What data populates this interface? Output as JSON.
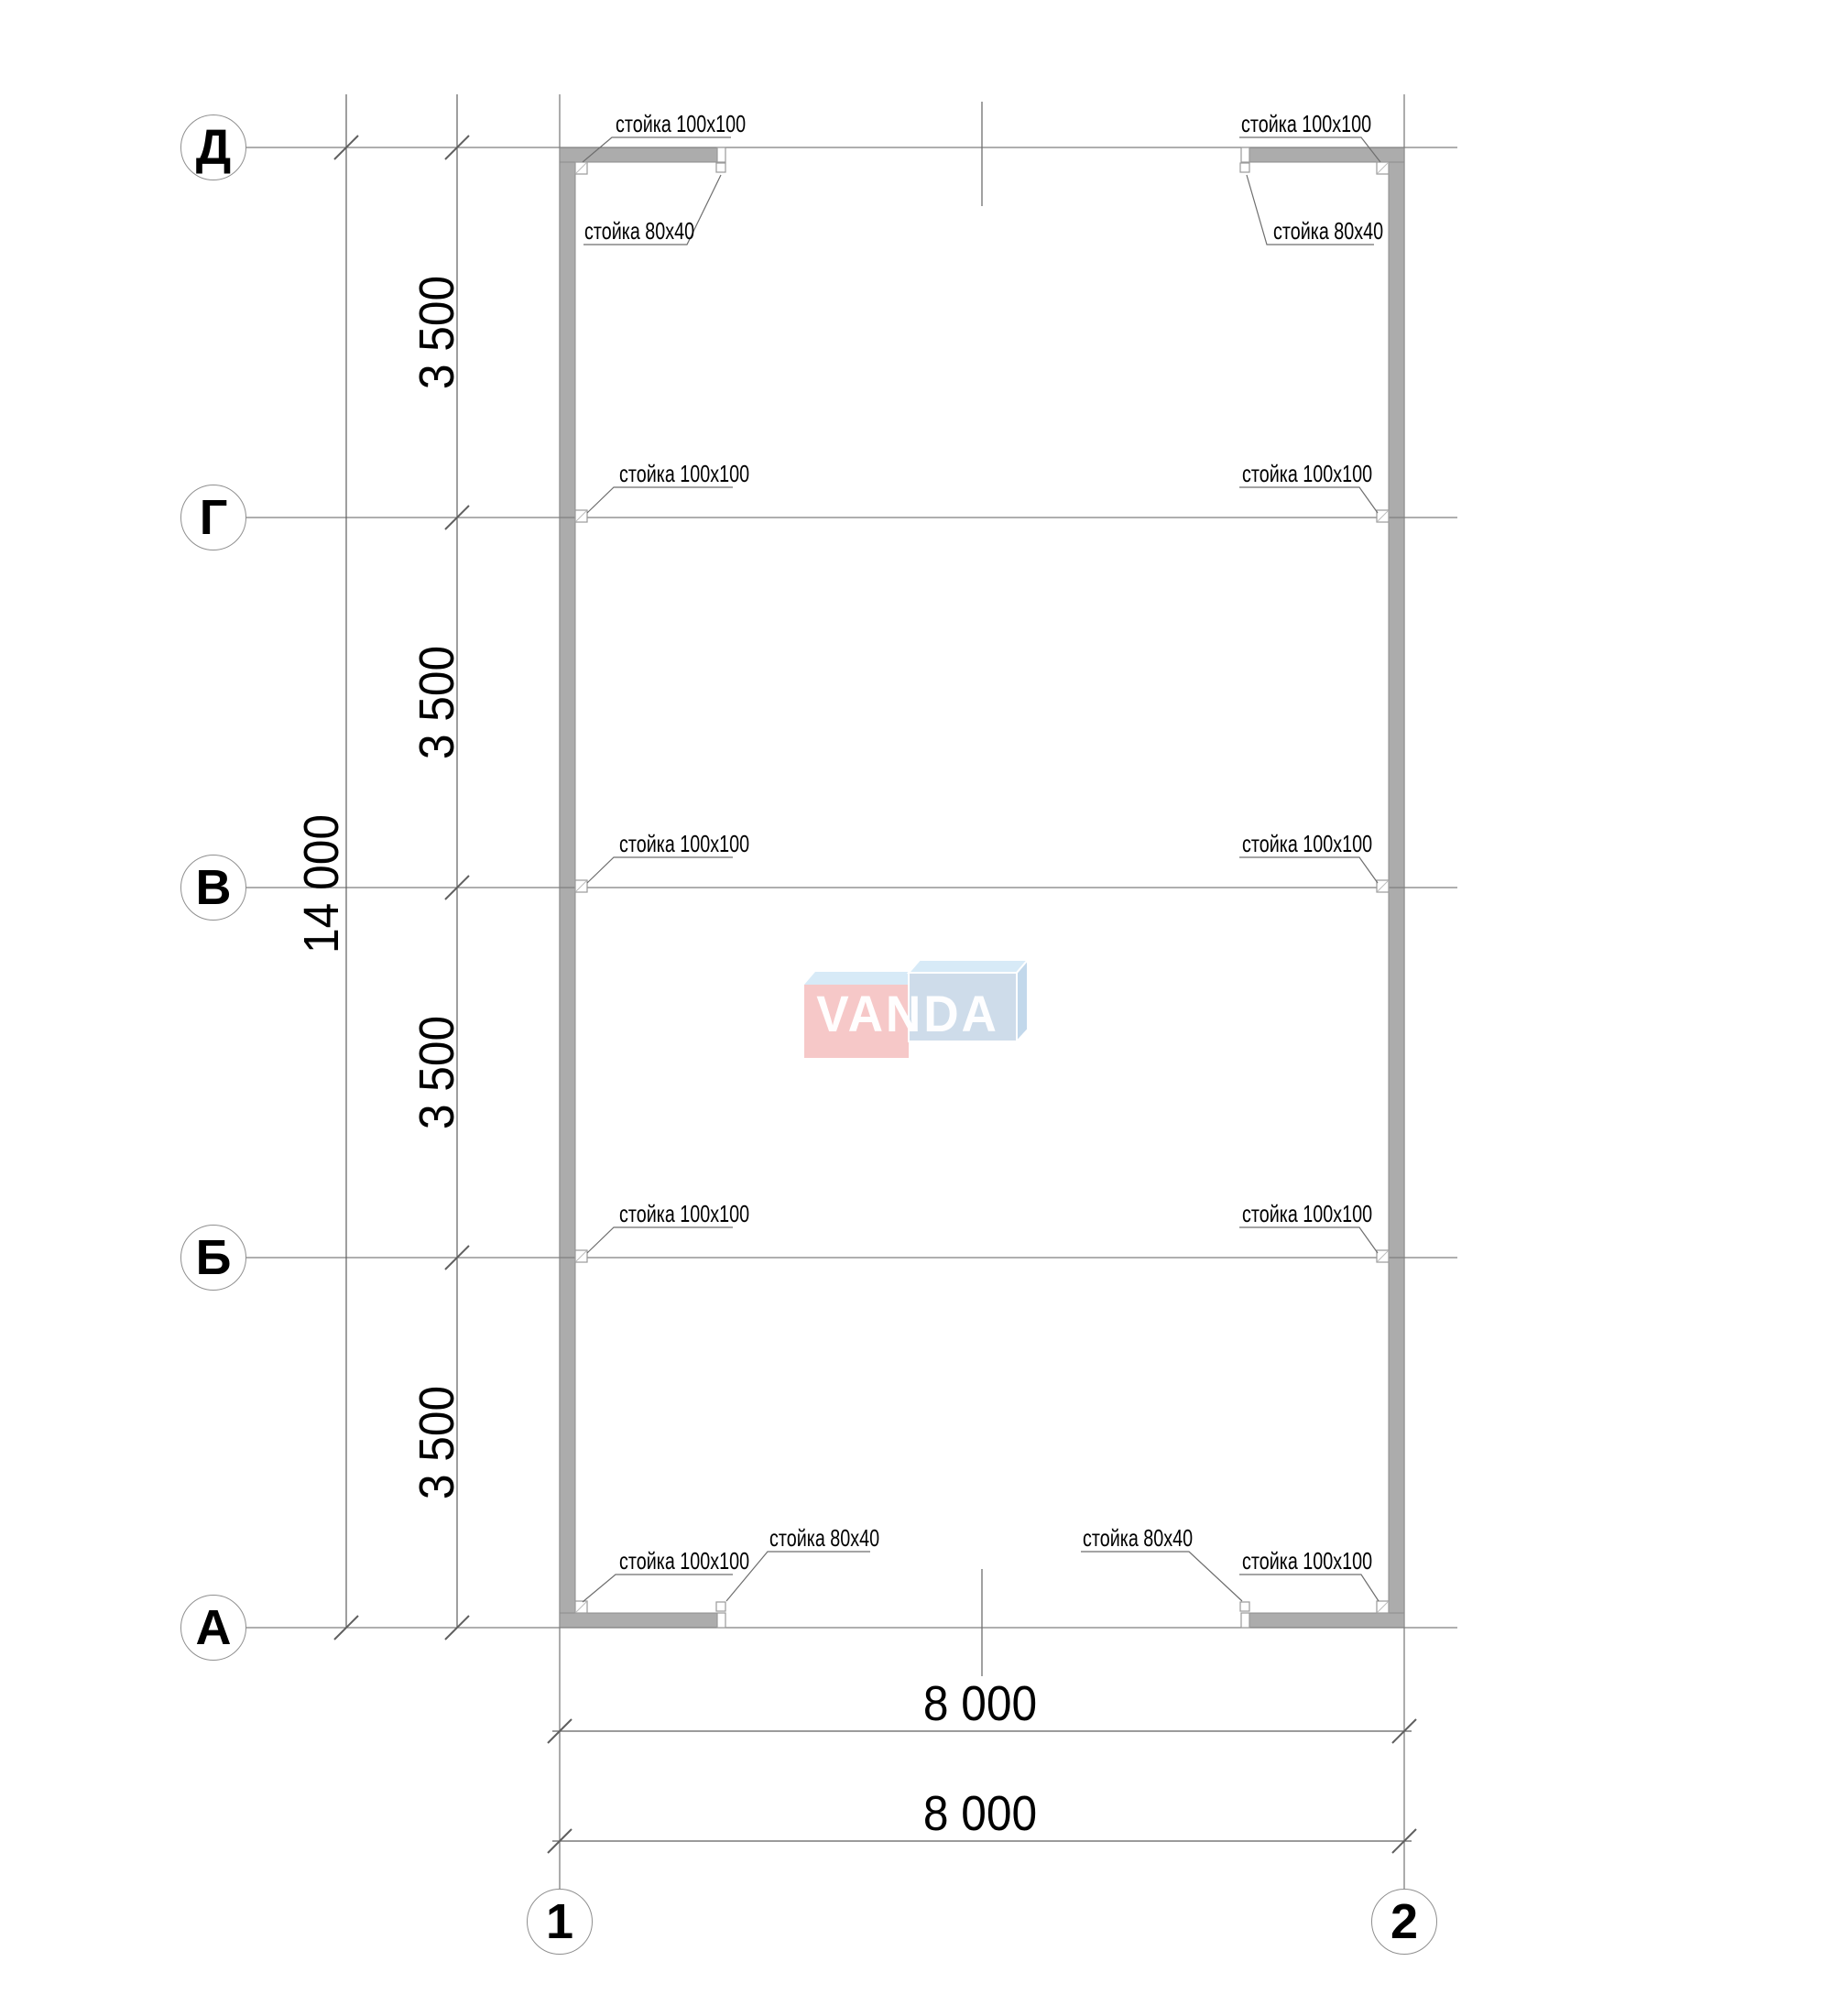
{
  "axis_rows": [
    {
      "label": "Д"
    },
    {
      "label": "Г"
    },
    {
      "label": "В"
    },
    {
      "label": "Б"
    },
    {
      "label": "А"
    }
  ],
  "axis_cols": [
    {
      "label": "1"
    },
    {
      "label": "2"
    }
  ],
  "dims": {
    "overall_height": "14 000",
    "bays": [
      {
        "label": "3 500"
      },
      {
        "label": "3 500"
      },
      {
        "label": "3 500"
      },
      {
        "label": "3 500"
      }
    ],
    "width_upper": "8 000",
    "width_lower": "8 000"
  },
  "leaders": [
    {
      "id": "top-left-corner-post",
      "text": "стойка 100x100"
    },
    {
      "id": "top-left-opening-post",
      "text": "стойка 80x40"
    },
    {
      "id": "top-right-corner-post",
      "text": "стойка 100x100"
    },
    {
      "id": "top-right-opening-post",
      "text": "стойка 80x40"
    },
    {
      "id": "left-axis-g-post",
      "text": "стойка 100x100"
    },
    {
      "id": "right-axis-g-post",
      "text": "стойка 100x100"
    },
    {
      "id": "left-axis-v-post",
      "text": "стойка 100x100"
    },
    {
      "id": "right-axis-v-post",
      "text": "стойка 100x100"
    },
    {
      "id": "left-axis-b-post",
      "text": "стойка 100x100"
    },
    {
      "id": "right-axis-b-post",
      "text": "стойка 100x100"
    },
    {
      "id": "bottom-left-corner-post",
      "text": "стойка 100x100"
    },
    {
      "id": "bottom-left-opening-post",
      "text": "стойка 80x40"
    },
    {
      "id": "bottom-right-opening-post",
      "text": "стойка 80x40"
    },
    {
      "id": "bottom-right-corner-post",
      "text": "стойка 100x100"
    }
  ],
  "watermark": {
    "text": "VANDA"
  },
  "colors": {
    "wall_fill": "#ACACAC",
    "wall_stroke": "#8C8C8C",
    "grid_line": "#7F7F7F",
    "dim_line": "#5F5F5F",
    "logo_pink": "#F6C8C8",
    "logo_blue": "#CEDCEA",
    "logo_flap_light_blue": "#D7EAF7",
    "logo_side_blue": "#C2D8EB"
  }
}
